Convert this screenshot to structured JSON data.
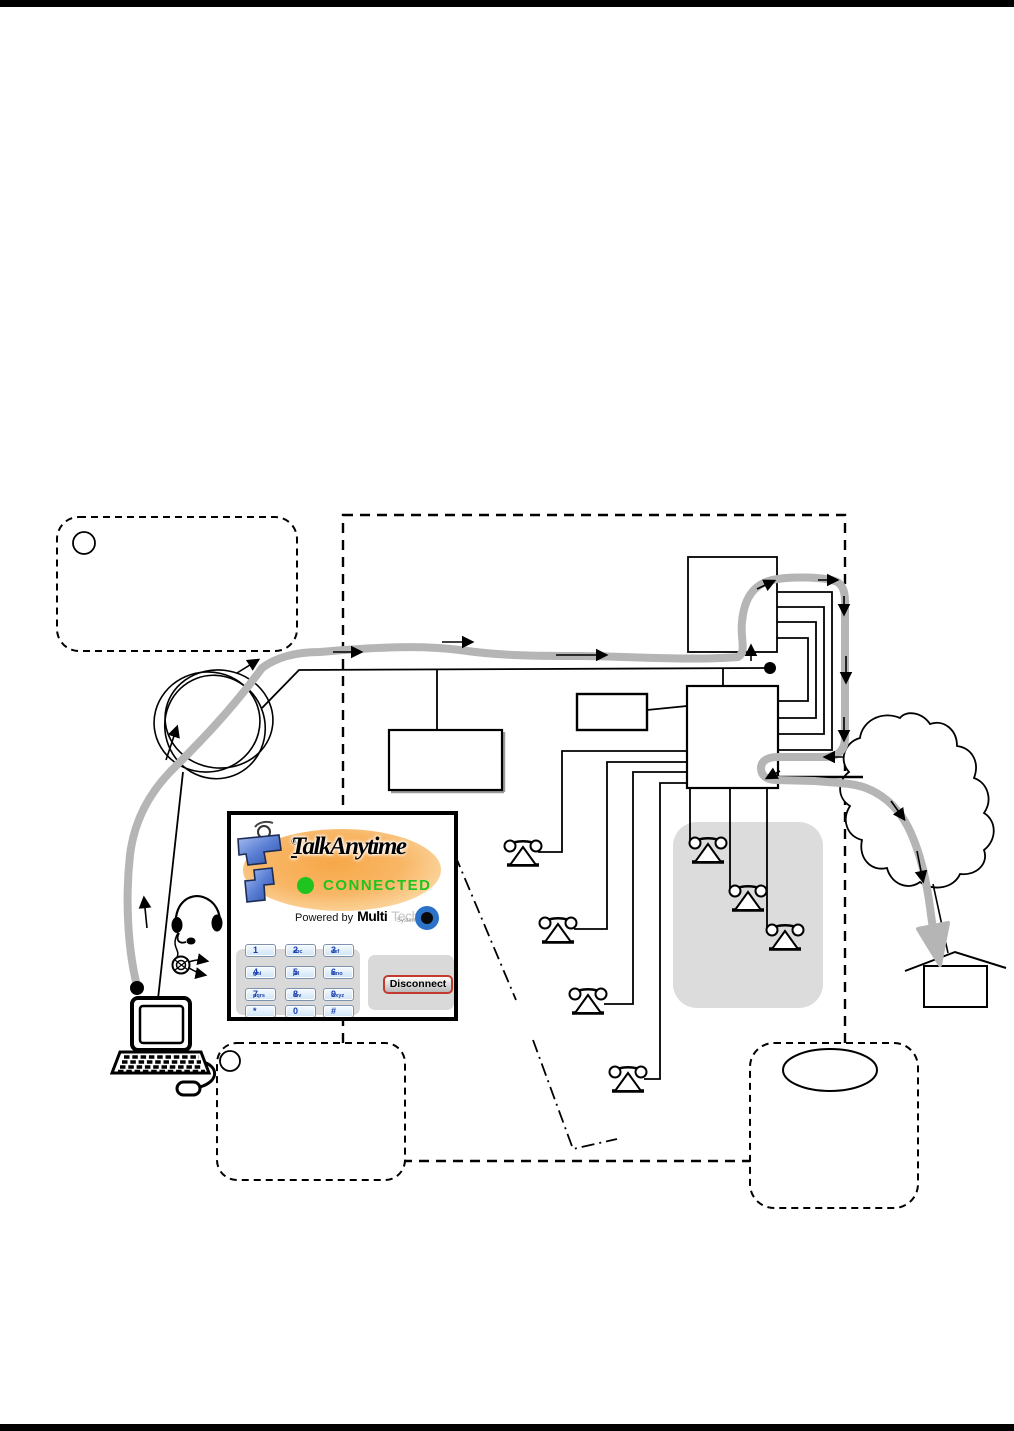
{
  "page": {
    "description": "Scanned manual page with VoIP softphone call-flow diagram",
    "top_rule": true,
    "bottom_rule": true
  },
  "softphone": {
    "brand": "TalkAnytime",
    "trademark": "®",
    "status_label": "CONNECTED",
    "powered_prefix": "Powered by",
    "powered_brand_bold": "Multi",
    "powered_brand_light": "Tech",
    "powered_brand_sub": "Systems",
    "disconnect_label": "Disconnect",
    "keypad": [
      {
        "digit": "1",
        "letters": ""
      },
      {
        "digit": "2",
        "letters": "abc"
      },
      {
        "digit": "3",
        "letters": "def"
      },
      {
        "digit": "4",
        "letters": "ghi"
      },
      {
        "digit": "5",
        "letters": "jkl"
      },
      {
        "digit": "6",
        "letters": "mno"
      },
      {
        "digit": "7",
        "letters": "pqrs"
      },
      {
        "digit": "8",
        "letters": "tuv"
      },
      {
        "digit": "9",
        "letters": "wxyz"
      },
      {
        "digit": "*",
        "letters": ""
      },
      {
        "digit": "0",
        "letters": ""
      },
      {
        "digit": "#",
        "letters": ""
      }
    ],
    "colors": {
      "connected_green": "#1fc41f",
      "logo_orange": "#f6a94e",
      "logo_phone_blue": "#4a6fd0",
      "keypad_blue": "#d8ebfa",
      "disconnect_red": "#c33a2e"
    }
  },
  "diagram": {
    "callout_count": 3,
    "phone_extension_count": 7,
    "colors": {
      "call_path_gray": "#b5b5b5",
      "phone_zone_gray": "#dcdcdc"
    }
  }
}
